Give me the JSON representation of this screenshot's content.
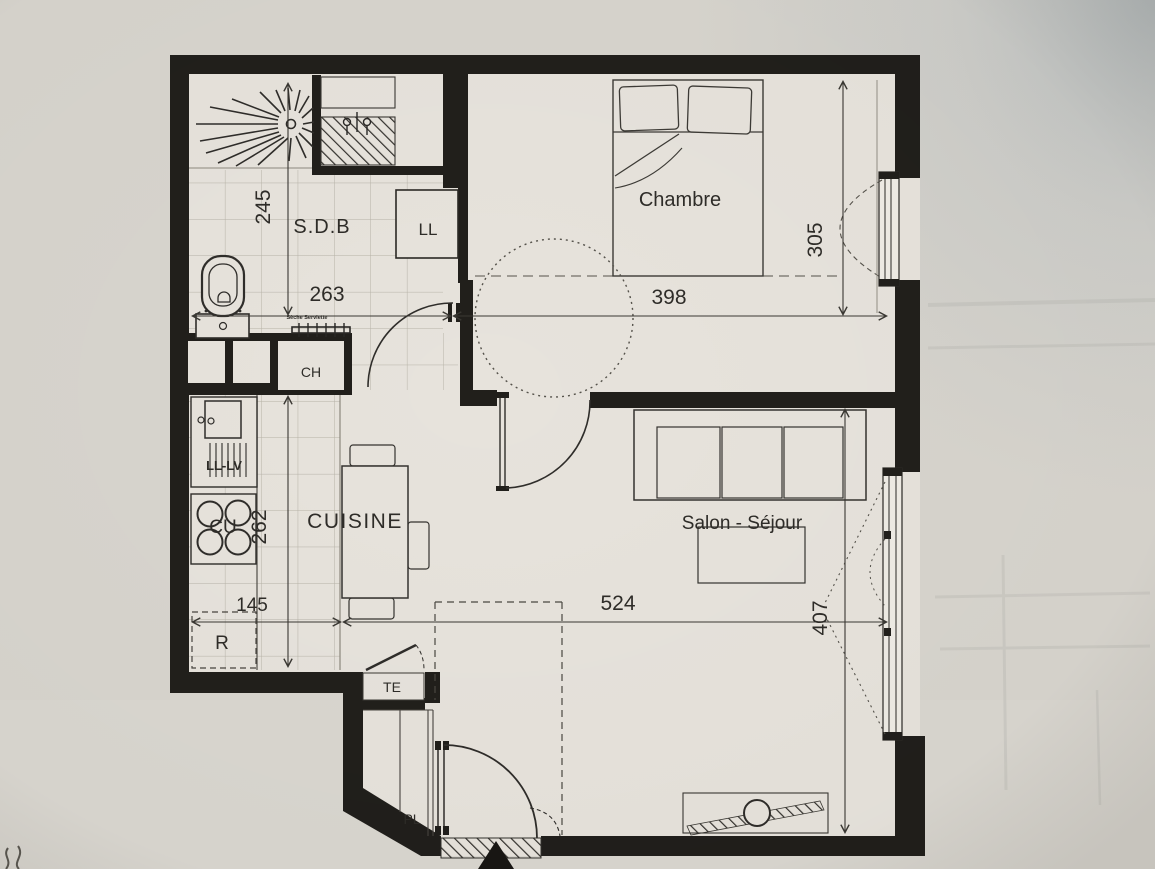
{
  "plan": {
    "labels": {
      "sdb": "S.D.B",
      "chambre": "Chambre",
      "cuisine": "CUISINE",
      "salon_sejour": "Salon - Séjour",
      "ll": "LL",
      "ch": "CH",
      "te": "TE",
      "pl": "PL",
      "cu": "CU",
      "ll_lv": "LL-LV",
      "r": "R",
      "seche_serviette": "Sèche Serviette"
    },
    "dimensions_cm": {
      "sdb_depth": "245",
      "sdb_width": "263",
      "chambre_width": "398",
      "chambre_depth": "305",
      "cuisine_depth": "262",
      "cuisine_width": "145",
      "salon_width": "524",
      "salon_depth": "407"
    }
  }
}
